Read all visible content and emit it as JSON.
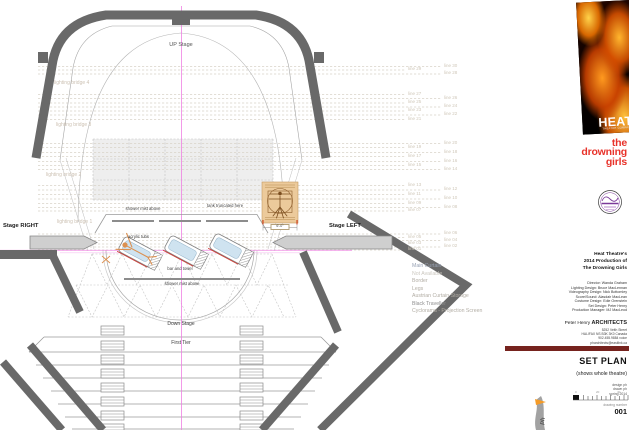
{
  "colors": {
    "accent_centerline": "#ef7ce2",
    "wall_gray": "#696969",
    "poster_red": "#e8322a",
    "title_bar_maroon": "#76231e",
    "tub_water_blue": "#cfe3f0",
    "tub_edge_red": "#cc3b33",
    "figure_orange": "#dc9050",
    "seal_purple": "#7b3a99"
  },
  "plan": {
    "labels": {
      "up_stage": "UP Stage",
      "down_stage": "Down Stage",
      "first_tier": "First Tier",
      "stage_right": "Stage RIGHT",
      "stage_left": "Stage LEFT"
    },
    "bridges": [
      "lighting bridge 4",
      "lighting bridge 3",
      "lighting bridge 2",
      "lighting bridge 1"
    ],
    "fly_lines": [
      "line 30",
      "line 29",
      "line 28",
      "line 27",
      "line 26",
      "line 25",
      "line 24",
      "line 23",
      "line 22",
      "line 21",
      "line 20",
      "line 19",
      "line 18",
      "line 17",
      "line 16",
      "line 15",
      "line 14",
      "line 13",
      "line 12",
      "line 11",
      "line 10",
      "line 09",
      "line 08",
      "line 07",
      "line 06",
      "line 05",
      "line 04",
      "line 03",
      "line 02",
      "line 01"
    ],
    "annotations": {
      "shower_mist_top": "shower mist above",
      "tank_truncated": "tank truncated here",
      "acrylic_tubs": "acrylic tubs",
      "bar_and_towel": "bar and towel",
      "shower_mist_bottom": "shower mist above",
      "tub_dimension": "6'-0\""
    },
    "legend": [
      {
        "label": "Main Curtain",
        "color": "#98a2b4"
      },
      {
        "label": "Not Available",
        "color": "#ccc8c0"
      },
      {
        "label": "Border",
        "color": "#b2ada4"
      },
      {
        "label": "Legs",
        "color": "#b2ada4"
      },
      {
        "label": "Austrian Curtain Storage",
        "color": "#b2ada4"
      },
      {
        "label": "Black Traveller",
        "color": "#8e8e8e"
      },
      {
        "label": "Cyclorama - Projection Screen",
        "color": "#b2ada4"
      }
    ]
  },
  "title_block": {
    "poster": {
      "brand": "HEAT",
      "brand_sub": "THEATRE COMPANY",
      "show_title_lines": [
        "the",
        "drowning",
        "girls"
      ]
    },
    "production_heading": [
      "Heat Theatre's",
      "2014 Production of",
      "The Drowning Girls"
    ],
    "credits": [
      "Director: Wanda Graham",
      "Lighting Design: Bruce MacLennan",
      "Videography Design: Nick Bottomley",
      "Score/Sound: Alasdair MacLean",
      "Costume Design: Edie Orenstein",
      "Set Design: Peter Henry",
      "Production Manager: MJ MacLeod"
    ],
    "architect": {
      "name": "Peter Henry",
      "firm": "ARCHITECTS",
      "address_lines": [
        "5252 Veith Street",
        "HALIFAX NS  B3K 3K0  Canada",
        "902.455.9884 voice",
        "pharchitects@eastlink.ca"
      ]
    },
    "sheet": {
      "title": "SET PLAN",
      "subtitle": "(shows whole theatre)",
      "meta_lines": [
        "design ph",
        "drawn ph",
        "spring 2014"
      ],
      "scale_ticks": [
        "0",
        "20",
        "40"
      ],
      "drawing_number_label": "drawing number",
      "drawing_number": "001"
    }
  }
}
